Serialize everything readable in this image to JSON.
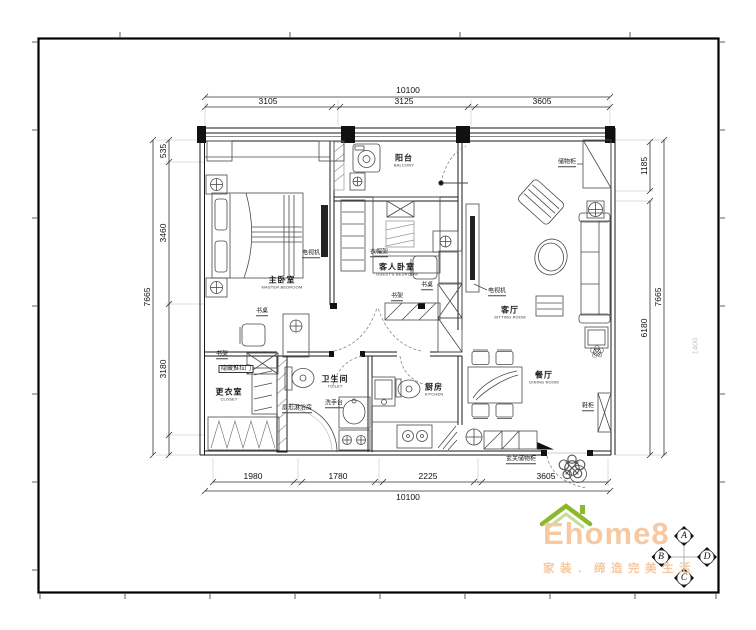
{
  "dims": {
    "top": {
      "total": "10100",
      "segs": [
        "3105",
        "3125",
        "3605"
      ]
    },
    "bottom": {
      "total": "10100",
      "segs": [
        "1980",
        "1780",
        "2225",
        "3605"
      ]
    },
    "left": {
      "total": "7665",
      "segs": [
        "535",
        "3460",
        "3180"
      ]
    },
    "right": {
      "total": "7665",
      "segs": [
        "1185",
        "6180"
      ]
    },
    "note": "1400"
  },
  "rooms": {
    "balcony": {
      "name": "阳台",
      "name_en": "BALCONY"
    },
    "master_bedroom": {
      "name": "主卧室",
      "name_en": "MASTER BEDROOM"
    },
    "guest_bedroom": {
      "name": "客人卧室",
      "name_en": "GUEST'S BEDROOM"
    },
    "living_room": {
      "name": "客厅",
      "name_en": "SITTING ROOM"
    },
    "dining_room": {
      "name": "餐厅",
      "name_en": "DINING ROOM"
    },
    "kitchen": {
      "name": "厨房",
      "name_en": "KITCHEN"
    },
    "bathroom": {
      "name": "卫生间",
      "name_en": "TOILET"
    },
    "closet": {
      "name": "更衣室",
      "name_en": "CLOSET"
    }
  },
  "furniture": {
    "tv_master": "电视机",
    "coat_rack": "衣帽架",
    "desk_guest": "书桌",
    "bookshelf_guest": "书架",
    "tv_living": "电视机",
    "storage_cabinet": "储物柜",
    "desk_master": "书桌",
    "bookshelf_master": "书架",
    "hidden_sliding_door": "隐藏推拉门",
    "washbasin": "洗手台",
    "shower": "扇形淋浴房",
    "shoe_cabinet": "鞋柜",
    "entry_storage": "玄关储物柜"
  },
  "logo": {
    "brand": "Ehome8",
    "slogan": "家装．缔造完美生活",
    "brand_color": "#f6c9a2",
    "roof_color": "#8cb82b"
  },
  "compass": {
    "a": "A",
    "b": "B",
    "c": "C",
    "d": "D"
  }
}
